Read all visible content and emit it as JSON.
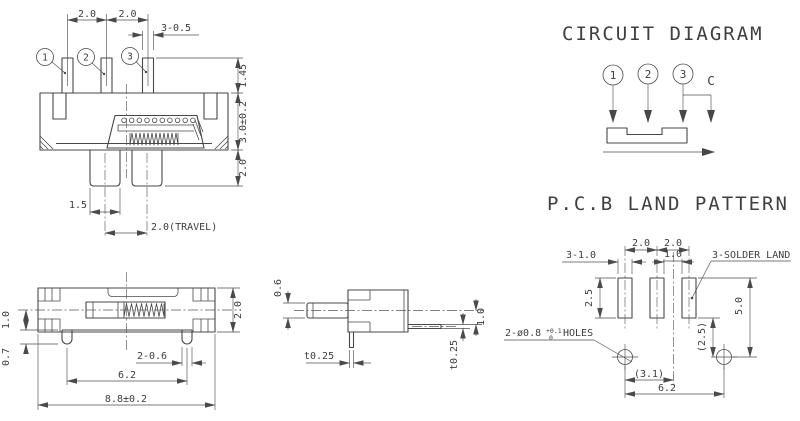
{
  "meta": {
    "background": "#ffffff",
    "line_color": "#474747",
    "text_color": "#3d3d3d"
  },
  "front_view": {
    "pin_labels": [
      "1",
      "2",
      "3"
    ],
    "dim_pitch_left": "2.0",
    "dim_pitch_right": "2.0",
    "dim_pin_width": "3-0.5",
    "dim_pin_height": "1.45",
    "dim_body_height": "3.0±0.2",
    "dim_leg_height": "2.0",
    "dim_knob_width": "1.5",
    "dim_travel": "2.0(TRAVEL)"
  },
  "circuit_diagram": {
    "title": "CIRCUIT DIAGRAM",
    "pin_labels": [
      "1",
      "2",
      "3"
    ],
    "common_label": "C"
  },
  "pcb_land_pattern": {
    "title": "P.C.B LAND PATTERN",
    "dim_pitch_left": "2.0",
    "dim_pitch_right": "2.0",
    "dim_pad_width": "3-1.0",
    "dim_pad_gap": "1.0",
    "solder_land_label": "3-SOLDER LAND",
    "dim_pad_height": "2.5",
    "dim_pad_to_hole": "5.0",
    "dim_hole_offset_v": "(2.5)",
    "holes_label": "2-ø0.8",
    "holes_tol_upper": "+0.1",
    "holes_tol_lower": "0",
    "holes_suffix": "HOLES",
    "dim_hole_to_center": "(3.1)",
    "dim_hole_pitch": "6.2"
  },
  "bottom_view": {
    "dim_center_to_edge": "1.0",
    "dim_plate_offset": "0.7",
    "dim_frame_width": "2.0",
    "dim_leg_width": "2-0.6",
    "dim_leg_pitch": "6.2",
    "dim_total_length": "8.8±0.2"
  },
  "side_view": {
    "dim_shaft_thickness": "0.6",
    "dim_bottom_pin_thickness": "t0.25",
    "dim_pin_offset": "1.0",
    "dim_side_pin_thickness": "t0.25"
  }
}
